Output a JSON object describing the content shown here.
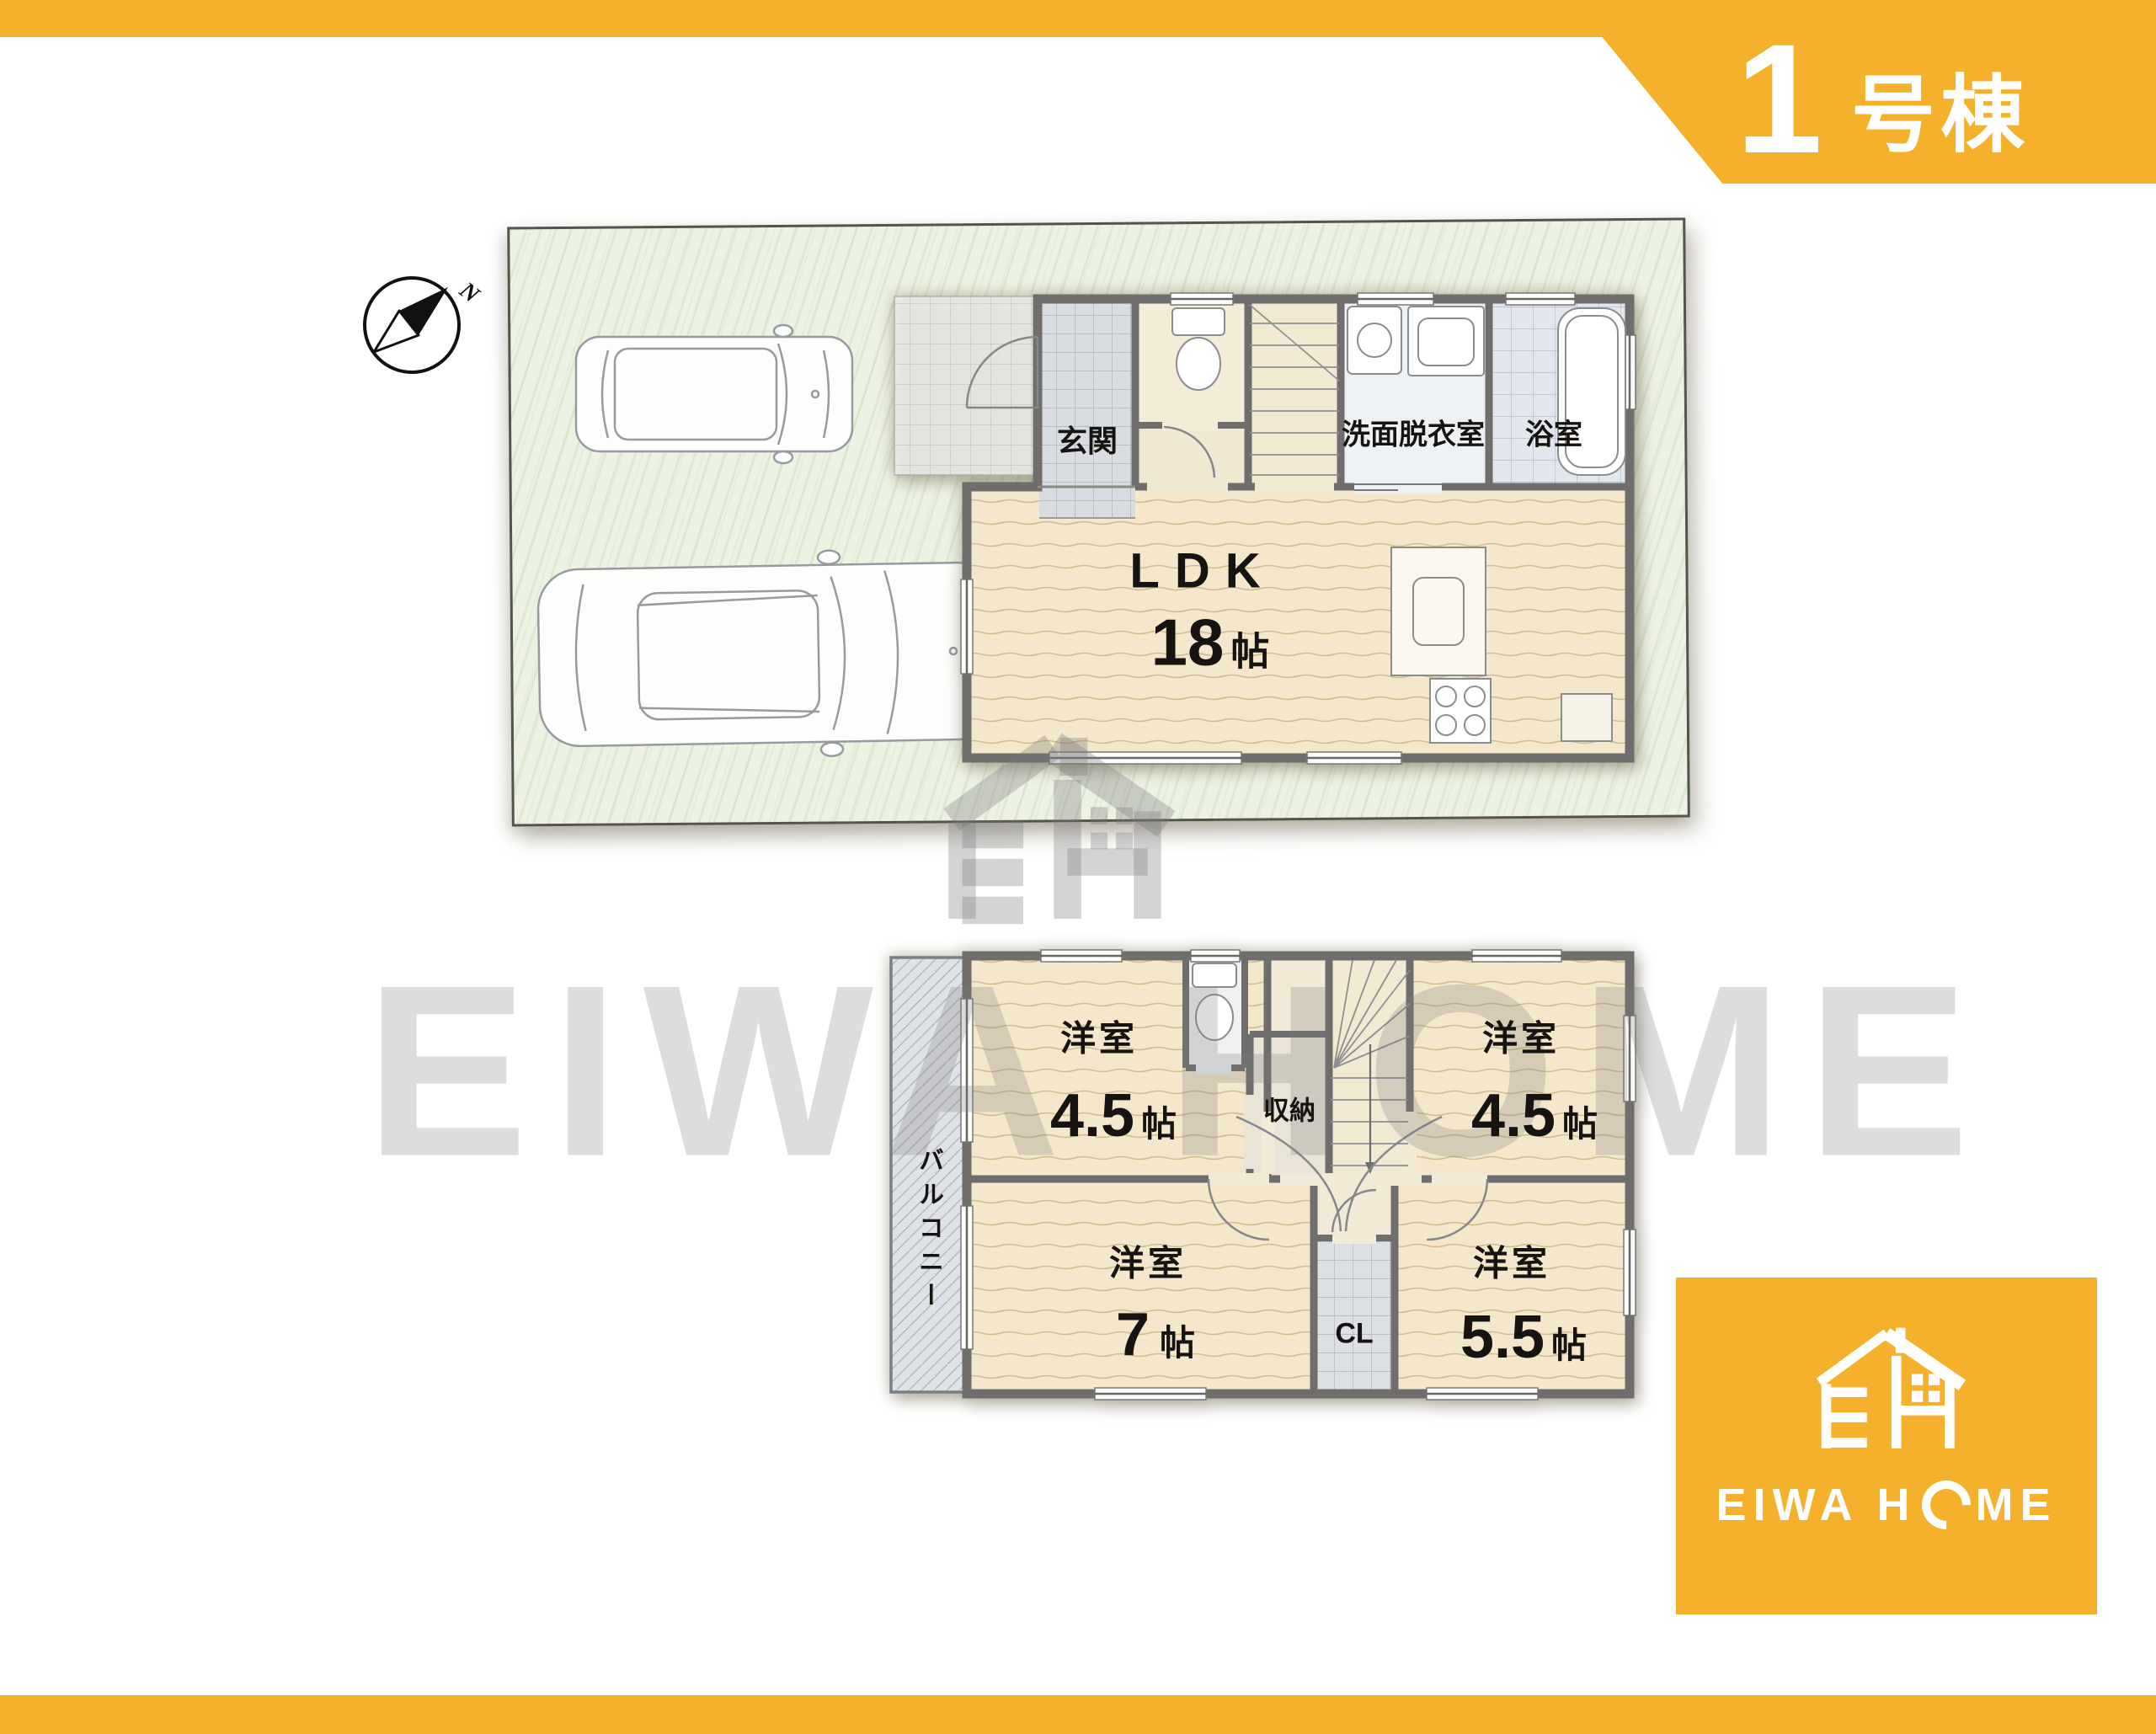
{
  "banner": {
    "number": "1",
    "suffix": "号棟"
  },
  "compass": {
    "north_label": "N"
  },
  "floor1": {
    "genkan": "玄関",
    "washroom": "洗面脱衣室",
    "bathroom": "浴室",
    "ldk_label": "LDK",
    "ldk_num": "18",
    "ldk_unit": "帖"
  },
  "floor2": {
    "balcony": "バルコニー",
    "room_tl_label": "洋室",
    "room_tl_num": "4.5",
    "room_tl_unit": "帖",
    "closet": "収納",
    "room_tr_label": "洋室",
    "room_tr_num": "4.5",
    "room_tr_unit": "帖",
    "room_bl_label": "洋室",
    "room_bl_num": "7",
    "room_bl_unit": "帖",
    "cl": "CL",
    "room_br_label": "洋室",
    "room_br_num": "5.5",
    "room_br_unit": "帖"
  },
  "logo": {
    "brand_pre": "EIWA H",
    "brand_post": "ME"
  },
  "watermark": {
    "text": "EIWA HOME"
  },
  "colors": {
    "accent_orange": "#f5b02c",
    "plot_green": "#edf2e3",
    "room_beige": "#f4e7cb",
    "wall_gray": "#6f6e6c"
  }
}
